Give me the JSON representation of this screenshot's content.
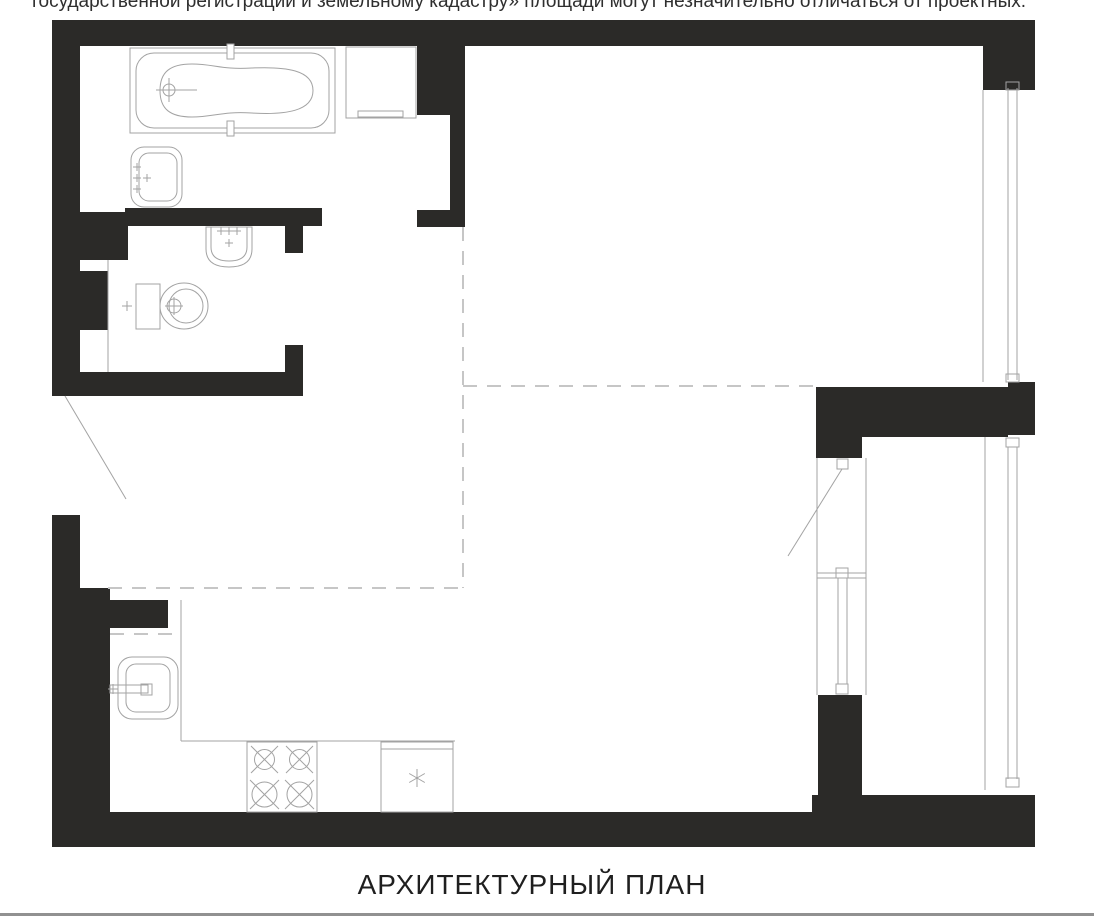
{
  "header": {
    "disclaimer": "государственной регистрации и земельному кадастру» площади могут незначительно отличаться от проектных."
  },
  "footer": {
    "title": "АРХИТЕКТУРНЫЙ ПЛАН"
  },
  "colors": {
    "background": "#ffffff",
    "wall": "#2b2a28",
    "line": "#a3a3a3",
    "dash": "#c6c6c6",
    "text": "#2f2f2f",
    "title_text": "#1f1f1f",
    "divider": "#919191"
  },
  "plan": {
    "type": "architectural-floor-plan",
    "fixtures": [
      "bathtub",
      "washing-machine",
      "bathroom-sink",
      "wc-wall-basin",
      "toilet",
      "kitchen-sink",
      "stove-4-burners",
      "fridge",
      "kitchen-counter"
    ],
    "doors": [
      "entrance-door-swing",
      "balcony-door-swing",
      "bathroom-doorway",
      "wc-doorway"
    ],
    "windows": [
      "window-upper-right",
      "window-lower-right",
      "balcony-window"
    ],
    "zone_dividers": "dashed-lines"
  }
}
